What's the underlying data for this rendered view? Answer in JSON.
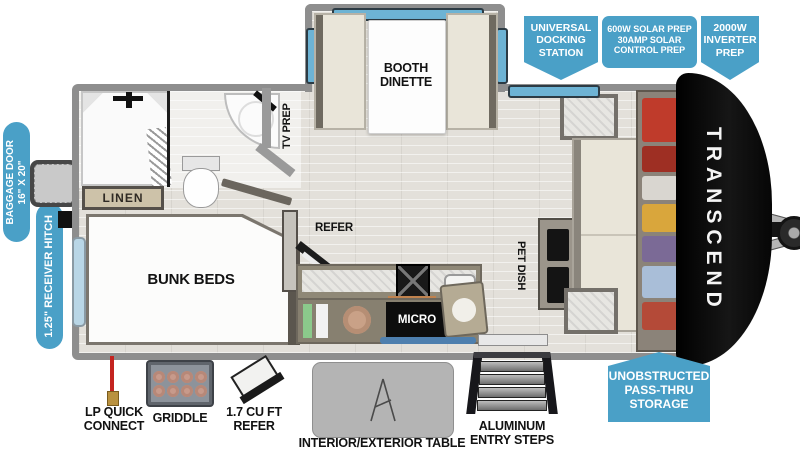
{
  "title": "Transcend travel trailer floorplan",
  "colors": {
    "badge_blue": "#4aa0c7",
    "window_blue": "#6db3d4",
    "wall_gray": "#8e8e8e",
    "furniture_cream": "#e9e5d9",
    "label_black": "#121212"
  },
  "badges": {
    "universal_docking": {
      "lines": [
        "UNIVERSAL",
        "DOCKING",
        "STATION"
      ]
    },
    "solar_prep": {
      "lines": [
        "600W SOLAR PREP",
        "30AMP SOLAR",
        "CONTROL PREP"
      ]
    },
    "inverter_prep": {
      "lines": [
        "2000W",
        "INVERTER",
        "PREP"
      ]
    },
    "pass_thru": {
      "lines": [
        "UNOBSTRUCTED",
        "PASS-THRU",
        "STORAGE"
      ]
    }
  },
  "side_labels": {
    "baggage_door": "BAGGAGE DOOR\n16\" X 20\"",
    "receiver_hitch": "1.25\" RECEIVER HITCH"
  },
  "interior_labels": {
    "booth_dinette": "BOOTH\nDINETTE",
    "tv_prep": "TV PREP",
    "linen": "LINEN",
    "bunk_beds": "BUNK BEDS",
    "refer": "REFER",
    "micro": "MICRO",
    "pet_dish": "PET DISH"
  },
  "exterior_labels": {
    "awning": "16' AWNING",
    "lp_quick_connect": "LP QUICK\nCONNECT",
    "griddle": "GRIDDLE",
    "mini_refer": "1.7 CU FT\nREFER",
    "table": "INTERIOR/EXTERIOR TABLE",
    "entry_steps": "ALUMINUM\nENTRY STEPS"
  },
  "brand": {
    "name": "TRANSCEND"
  }
}
